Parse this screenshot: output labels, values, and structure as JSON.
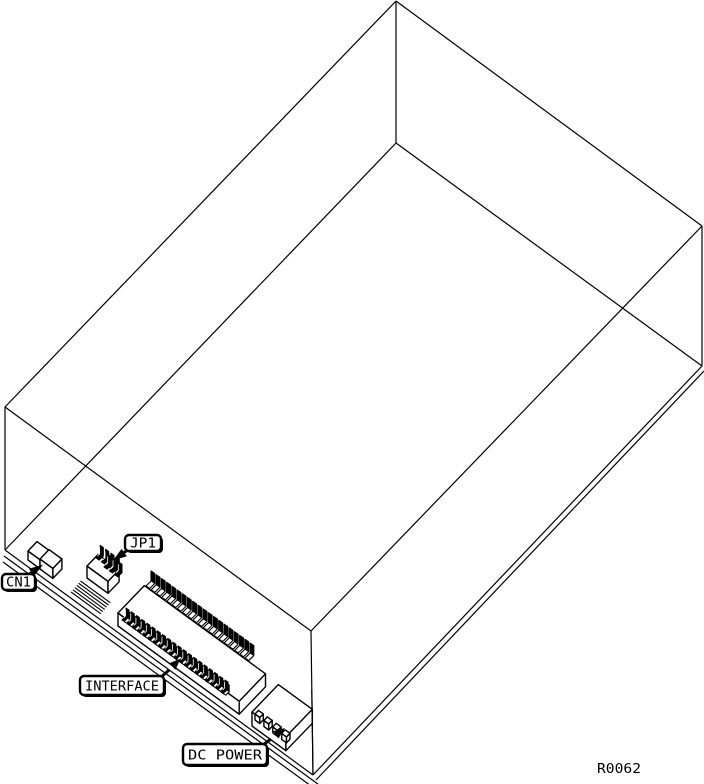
{
  "drawing": {
    "background_color": "#ffffff",
    "line_color": "#000000",
    "reference_number": "R0062",
    "labels": [
      {
        "id": "cn1",
        "text": "CN1"
      },
      {
        "id": "jp1",
        "text": "JP1"
      },
      {
        "id": "interface",
        "text": "INTERFACE"
      },
      {
        "id": "dc_power",
        "text": "DC POWER"
      }
    ]
  }
}
